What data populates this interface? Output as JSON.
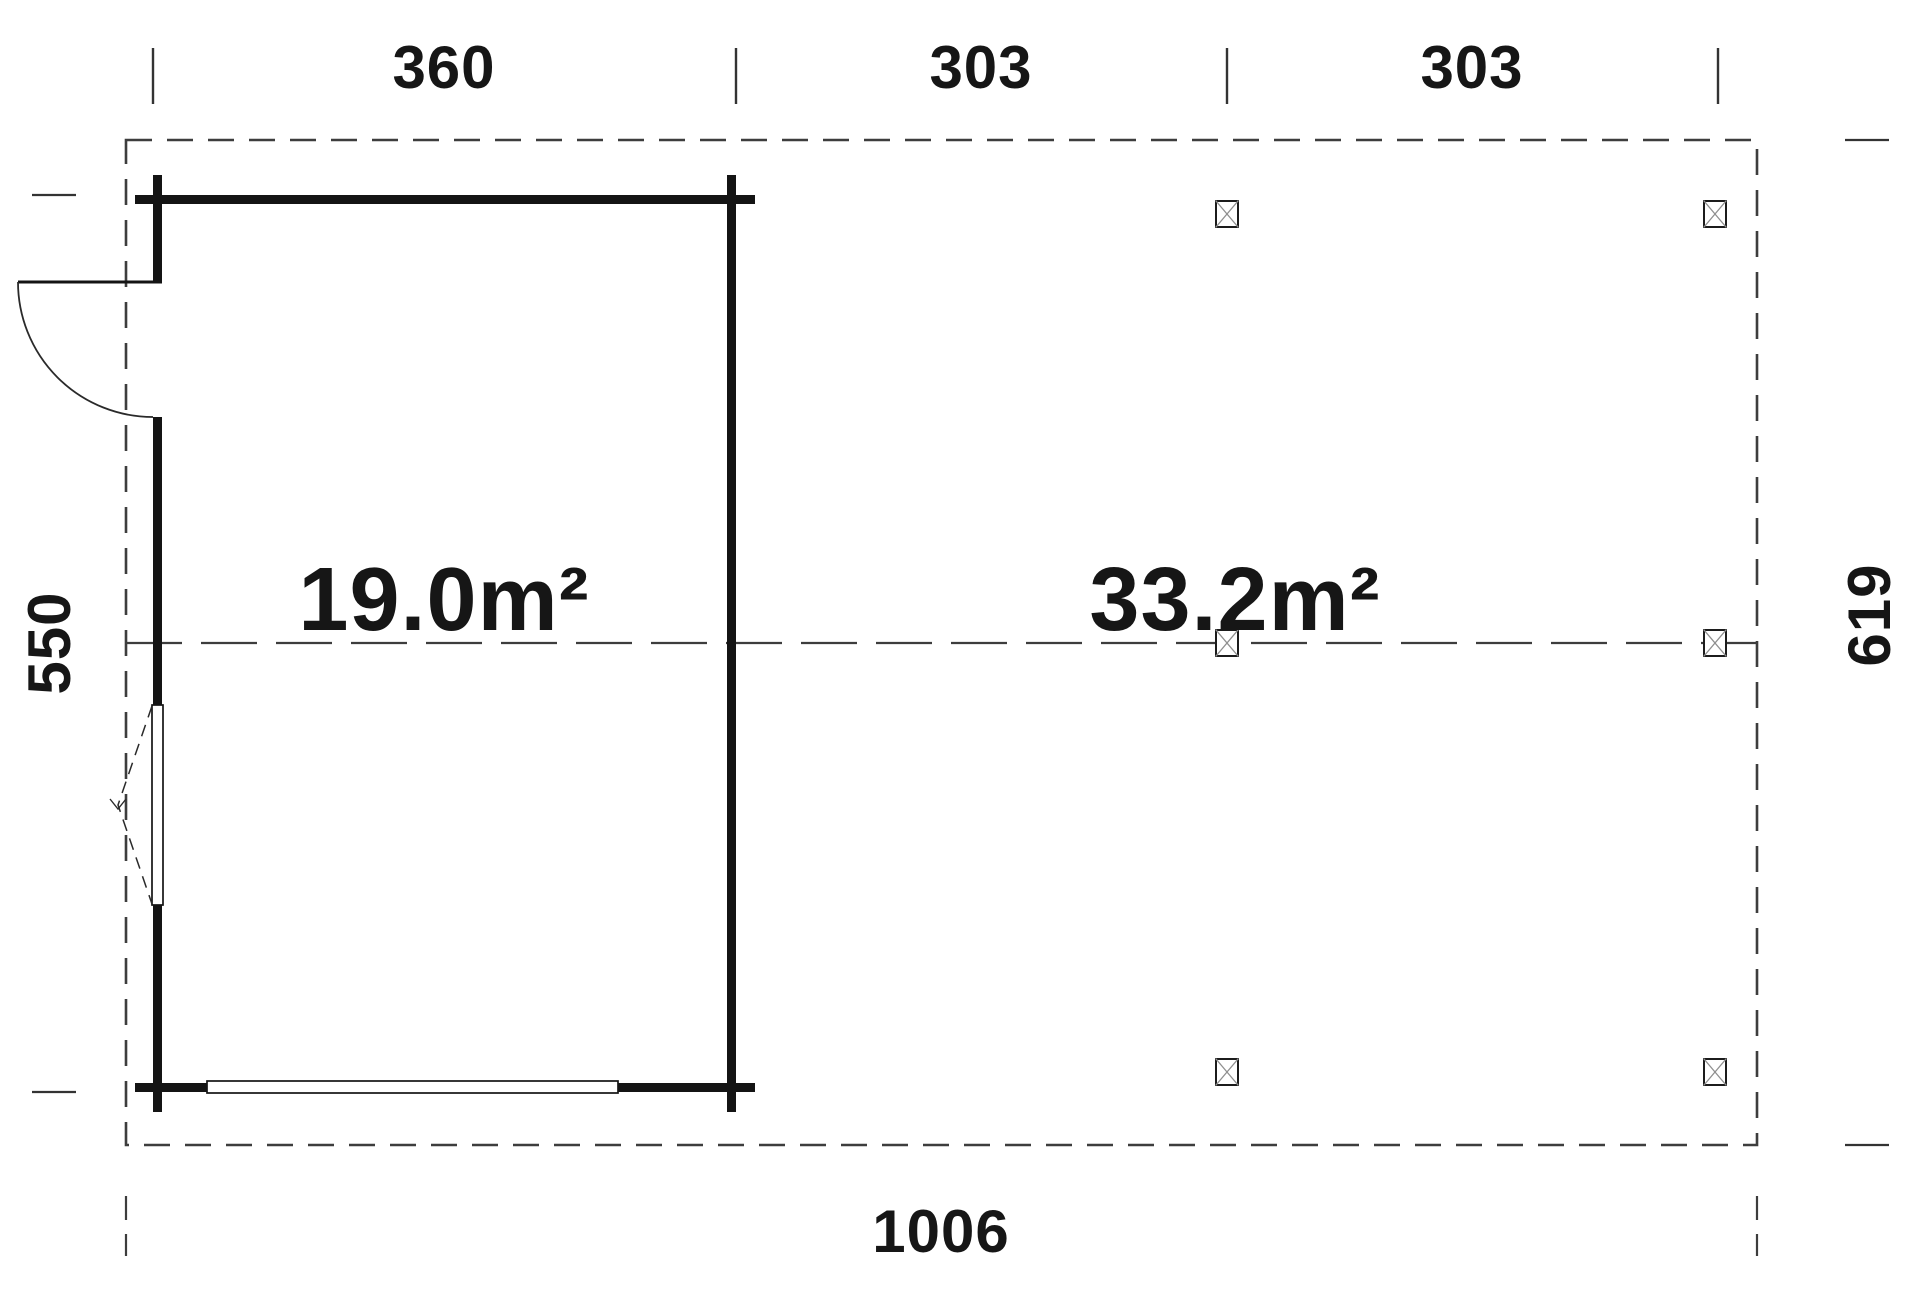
{
  "plan": {
    "title": "garage-carport-floor-plan",
    "colors": {
      "background": "#ffffff",
      "wall": "#141414",
      "roof_dash": "#3d3d3d",
      "axis_dash": "#3d3d3d",
      "post_cross": "#8f8f8f",
      "text": "#161616"
    },
    "top_dimensions": {
      "garage_width": "360",
      "carport_bay_1": "303",
      "carport_bay_2": "303"
    },
    "side_dimensions": {
      "left_height": "550",
      "right_height": "619"
    },
    "bottom_dimension": {
      "total_width": "1006"
    },
    "area_labels": {
      "garage": "19.0m²",
      "carport": "33.2m²"
    },
    "symbols": {
      "post_marker": "x-square-post",
      "door_swing": "quarter-arc",
      "window_opening": "dashed-triangle"
    }
  }
}
